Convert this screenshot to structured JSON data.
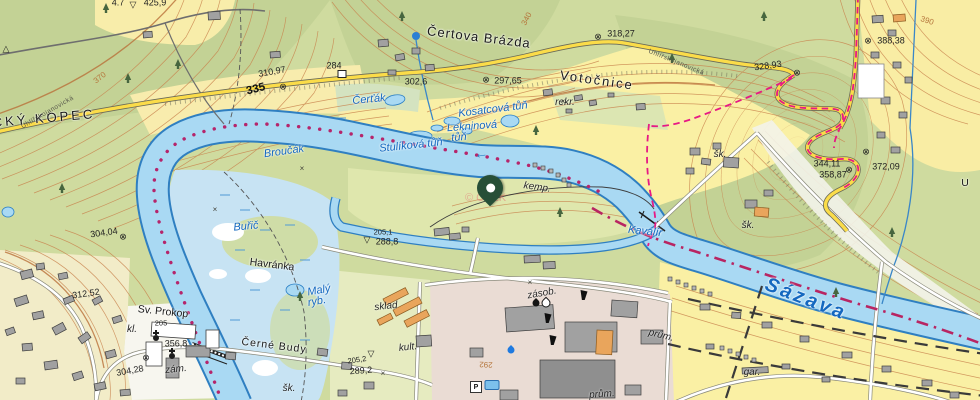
{
  "map": {
    "attribution": "© ČÚZK",
    "route_number": "335",
    "river_name": "Sázava",
    "marker": {
      "name": "selected-location",
      "x": 490,
      "y": 188
    },
    "colors": {
      "water_fill": "#a9d9f3",
      "water_line": "#2a7fc5",
      "road_yellow": "#fbdc49",
      "trail_red": "#e61a85",
      "boundary_magenta": "#b82562",
      "trail_dots": "#b5256b",
      "contour_brown": "#c8824d",
      "forest_green": "#c3d295",
      "field_yellow": "#f9efa6",
      "urban_pink": "#eadcd4",
      "pin_green": "#274f37",
      "label_blue": "#1468c0"
    },
    "labels": [
      {
        "text": "CKÝ KOPEC",
        "x": 44,
        "y": 118,
        "cls": "place big",
        "rot": -5,
        "ls": 3,
        "name": "label-kopec"
      },
      {
        "text": "4.7",
        "x": 118,
        "y": 3,
        "cls": "elev"
      },
      {
        "text": "▽",
        "x": 133,
        "y": 5,
        "cls": "sym"
      },
      {
        "text": "425,9",
        "x": 155,
        "y": 3,
        "cls": "elev"
      },
      {
        "text": "△",
        "x": 6,
        "y": 49,
        "cls": "sym"
      },
      {
        "text": "370",
        "x": 100,
        "y": 78,
        "cls": "contour",
        "rot": -38
      },
      {
        "text": "310,97",
        "x": 272,
        "y": 72,
        "cls": "elev",
        "rot": -10
      },
      {
        "text": "⊗",
        "x": 283,
        "y": 87,
        "cls": "sym"
      },
      {
        "text": "335",
        "x": 256,
        "y": 90,
        "cls": "route",
        "rot": -14,
        "name": "route-335"
      },
      {
        "text": "284",
        "x": 334,
        "y": 66,
        "cls": "elev"
      },
      {
        "text": "302,6",
        "x": 416,
        "y": 82,
        "cls": "elev"
      },
      {
        "text": "Uhlířskojanovická",
        "x": 48,
        "y": 113,
        "cls": "road",
        "rot": -30
      },
      {
        "text": "Uhlířskojanovická",
        "x": 676,
        "y": 63,
        "cls": "road",
        "rot": 22
      },
      {
        "text": "Čertova Brázda",
        "x": 479,
        "y": 37,
        "cls": "place big",
        "rot": 7,
        "ls": 1,
        "name": "label-certova-brazda"
      },
      {
        "text": "340",
        "x": 527,
        "y": 19,
        "cls": "contour",
        "rot": -62
      },
      {
        "text": "318,27",
        "x": 621,
        "y": 34,
        "cls": "elev"
      },
      {
        "text": "⊗",
        "x": 598,
        "y": 37,
        "cls": "sym"
      },
      {
        "text": "Votočnice",
        "x": 597,
        "y": 80,
        "cls": "place big",
        "rot": 8,
        "ls": 2,
        "name": "label-votocnice"
      },
      {
        "text": "rekr.",
        "x": 565,
        "y": 103,
        "cls": "abbr"
      },
      {
        "text": "297,65",
        "x": 508,
        "y": 81,
        "cls": "elev"
      },
      {
        "text": "⊗",
        "x": 486,
        "y": 80,
        "cls": "sym"
      },
      {
        "text": "Čerťák",
        "x": 369,
        "y": 100,
        "cls": "water",
        "rot": -5
      },
      {
        "text": "Kosatcová tůň",
        "x": 493,
        "y": 110,
        "cls": "water",
        "rot": -7
      },
      {
        "text": "Lekninová",
        "x": 472,
        "y": 127,
        "cls": "water",
        "rot": -4
      },
      {
        "text": "tůň",
        "x": 459,
        "y": 138,
        "cls": "water",
        "rot": -4
      },
      {
        "text": "Stulíková tůň",
        "x": 411,
        "y": 146,
        "cls": "water",
        "rot": -6
      },
      {
        "text": "Broučák",
        "x": 284,
        "y": 152,
        "cls": "water",
        "rot": -8
      },
      {
        "text": "Buřič",
        "x": 246,
        "y": 227,
        "cls": "water",
        "rot": -5
      },
      {
        "text": "Havránka",
        "x": 272,
        "y": 265,
        "cls": "place",
        "rot": 7
      },
      {
        "text": "Malý",
        "x": 319,
        "y": 291,
        "cls": "water",
        "rot": -10
      },
      {
        "text": "ryb.",
        "x": 317,
        "y": 302,
        "cls": "water",
        "rot": -10
      },
      {
        "text": "328,93",
        "x": 768,
        "y": 66,
        "cls": "elev",
        "rot": -8
      },
      {
        "text": "⊗",
        "x": 797,
        "y": 73,
        "cls": "sym"
      },
      {
        "text": "390",
        "x": 927,
        "y": 21,
        "cls": "contour",
        "rot": 18
      },
      {
        "text": "388,38",
        "x": 891,
        "y": 41,
        "cls": "elev"
      },
      {
        "text": "⊗",
        "x": 868,
        "y": 41,
        "cls": "sym"
      },
      {
        "text": "344,11",
        "x": 827,
        "y": 164,
        "cls": "elev"
      },
      {
        "text": "358,87",
        "x": 833,
        "y": 175,
        "cls": "elev"
      },
      {
        "text": "⊗",
        "x": 849,
        "y": 170,
        "cls": "sym"
      },
      {
        "text": "372,09",
        "x": 886,
        "y": 167,
        "cls": "elev"
      },
      {
        "text": "⊗",
        "x": 866,
        "y": 152,
        "cls": "sym"
      },
      {
        "text": "U",
        "x": 965,
        "y": 183,
        "cls": "place"
      },
      {
        "text": "šk.",
        "x": 720,
        "y": 155,
        "cls": "abbr"
      },
      {
        "text": "šk.",
        "x": 748,
        "y": 226,
        "cls": "abbr"
      },
      {
        "text": "šk.",
        "x": 289,
        "y": 389,
        "cls": "abbr"
      },
      {
        "text": "Kavalír",
        "x": 645,
        "y": 232,
        "cls": "water",
        "rot": 6,
        "name": "label-kavalir"
      },
      {
        "text": "kemp.",
        "x": 537,
        "y": 188,
        "cls": "abbr",
        "rot": 8,
        "name": "label-kemp"
      },
      {
        "text": "←",
        "x": 481,
        "y": 153,
        "cls": "flow",
        "rot": -8,
        "name": "river-flow-arrow"
      },
      {
        "text": "205,1",
        "x": 383,
        "y": 232,
        "cls": "elev small"
      },
      {
        "text": "288,8",
        "x": 387,
        "y": 242,
        "cls": "elev"
      },
      {
        "text": "▽",
        "x": 367,
        "y": 240,
        "cls": "sym"
      },
      {
        "text": "304,04",
        "x": 104,
        "y": 233,
        "cls": "elev",
        "rot": -8
      },
      {
        "text": "⊗",
        "x": 123,
        "y": 237,
        "cls": "sym"
      },
      {
        "text": "312,52",
        "x": 86,
        "y": 294,
        "cls": "elev",
        "rot": -8
      },
      {
        "text": "Sv. Prokop",
        "x": 163,
        "y": 312,
        "cls": "place",
        "rot": 6,
        "name": "label-sv-prokop"
      },
      {
        "text": "205",
        "x": 161,
        "y": 323,
        "cls": "elev small"
      },
      {
        "text": "kl.",
        "x": 132,
        "y": 330,
        "cls": "abbr"
      },
      {
        "text": "356,8",
        "x": 176,
        "y": 344,
        "cls": "elev"
      },
      {
        "text": "zám.",
        "x": 176,
        "y": 370,
        "cls": "abbr",
        "rot": -6
      },
      {
        "text": "304,28",
        "x": 130,
        "y": 371,
        "cls": "elev",
        "rot": -10
      },
      {
        "text": "⊗",
        "x": 146,
        "y": 358,
        "cls": "sym"
      },
      {
        "text": "Černé Budy",
        "x": 274,
        "y": 346,
        "cls": "place",
        "rot": 7,
        "ls": 1,
        "name": "label-cerne-budy"
      },
      {
        "text": "sklad",
        "x": 386,
        "y": 307,
        "cls": "abbr",
        "rot": -6
      },
      {
        "text": "kult.",
        "x": 408,
        "y": 348,
        "cls": "abbr",
        "rot": -6
      },
      {
        "text": "205,2",
        "x": 357,
        "y": 360,
        "cls": "elev small",
        "rot": -8
      },
      {
        "text": "▽",
        "x": 371,
        "y": 354,
        "cls": "sym"
      },
      {
        "text": "289,2",
        "x": 361,
        "y": 371,
        "cls": "elev",
        "rot": -4
      },
      {
        "text": "zásob.",
        "x": 542,
        "y": 294,
        "cls": "abbr",
        "rot": -10
      },
      {
        "text": "292",
        "x": 486,
        "y": 364,
        "cls": "contour",
        "rot": 182
      },
      {
        "text": "prům.",
        "x": 661,
        "y": 336,
        "cls": "abbr",
        "rot": 14
      },
      {
        "text": "prům.",
        "x": 602,
        "y": 395,
        "cls": "abbr",
        "rot": -4
      },
      {
        "text": "gar.",
        "x": 752,
        "y": 373,
        "cls": "abbr"
      },
      {
        "text": "Sázava",
        "x": 806,
        "y": 299,
        "cls": "river",
        "rot": 21,
        "ls": 3,
        "name": "label-river-sazava"
      },
      {
        "text": "×",
        "x": 302,
        "y": 169,
        "cls": "mark"
      },
      {
        "text": "×",
        "x": 215,
        "y": 210,
        "cls": "mark"
      },
      {
        "text": "×",
        "x": 530,
        "y": 283,
        "cls": "mark"
      },
      {
        "text": "×",
        "x": 383,
        "y": 374,
        "cls": "mark"
      },
      {
        "text": "×",
        "x": 563,
        "y": 102,
        "cls": "mark"
      }
    ],
    "symbols": [
      {
        "type": "spring",
        "x": 416,
        "y": 36
      },
      {
        "type": "church",
        "x": 156,
        "y": 338
      },
      {
        "type": "church",
        "x": 172,
        "y": 356
      },
      {
        "type": "box",
        "x": 342,
        "y": 74
      },
      {
        "type": "parking",
        "x": 476,
        "y": 387,
        "text": "P"
      },
      {
        "type": "drop-dark",
        "x": 536,
        "y": 303
      },
      {
        "type": "drop-outline",
        "x": 546,
        "y": 303
      },
      {
        "type": "drop-blue",
        "x": 511,
        "y": 350
      },
      {
        "type": "pool",
        "x": 492,
        "y": 385
      },
      {
        "type": "chimney",
        "x": 548,
        "y": 318
      },
      {
        "type": "chimney",
        "x": 553,
        "y": 340
      },
      {
        "type": "chimney",
        "x": 584,
        "y": 295
      }
    ]
  }
}
